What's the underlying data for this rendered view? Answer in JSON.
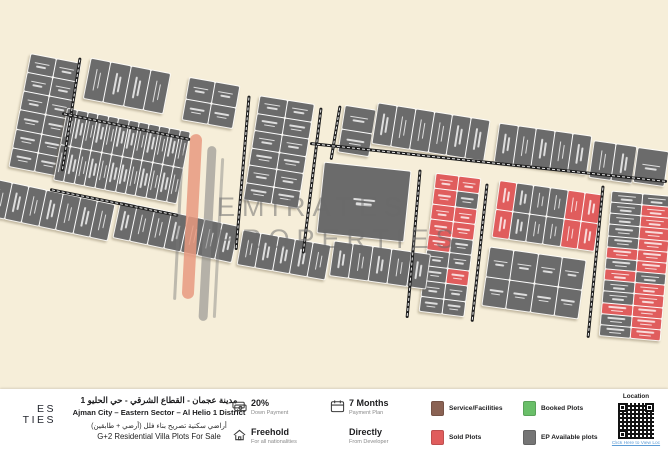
{
  "map": {
    "colors": {
      "background": "#f6eed9",
      "available": "#6b6b6b",
      "sold": "#e05d5d",
      "road": "#1f1f1f",
      "watermark_accent": "#e8997f"
    },
    "watermark": {
      "line1": "EMIRATES",
      "line2": "PROPERTIES"
    },
    "blocks": [
      {
        "id": "b1",
        "x": 20,
        "y": 58,
        "w": 50,
        "h": 114,
        "rot": 11,
        "cols": 2,
        "rows": 6
      },
      {
        "id": "b2",
        "x": 87,
        "y": 66,
        "w": 80,
        "h": 40,
        "rot": 11,
        "cols": 4,
        "rows": 1
      },
      {
        "id": "b3",
        "x": 186,
        "y": 82,
        "w": 50,
        "h": 42,
        "rot": 10,
        "cols": 2,
        "rows": 2
      },
      {
        "id": "b4",
        "x": 60,
        "y": 120,
        "w": 124,
        "h": 72,
        "rot": 11,
        "cols": 12,
        "rows": 2
      },
      {
        "id": "b6",
        "x": 252,
        "y": 100,
        "w": 54,
        "h": 104,
        "rot": 9,
        "cols": 2,
        "rows": 6
      },
      {
        "id": "b7",
        "x": 342,
        "y": 108,
        "w": 30,
        "h": 46,
        "rot": 9,
        "cols": 1,
        "rows": 2
      },
      {
        "id": "rt1",
        "x": 375,
        "y": 112,
        "w": 112,
        "h": 40,
        "rot": 9,
        "cols": 6,
        "rows": 1
      },
      {
        "id": "rt2",
        "x": 497,
        "y": 130,
        "w": 92,
        "h": 38,
        "rot": 8,
        "cols": 5,
        "rows": 1
      },
      {
        "id": "rt3",
        "x": 592,
        "y": 144,
        "w": 42,
        "h": 36,
        "rot": 8,
        "cols": 2,
        "rows": 1
      },
      {
        "id": "rt4",
        "x": 636,
        "y": 150,
        "w": 30,
        "h": 34,
        "rot": 8,
        "cols": 1,
        "rows": 1
      },
      {
        "id": "facility",
        "x": 321,
        "y": 167,
        "w": 86,
        "h": 70,
        "rot": 6,
        "cols": 1,
        "rows": 1,
        "kind": "facility"
      },
      {
        "id": "b11",
        "x": 428,
        "y": 176,
        "w": 44,
        "h": 138,
        "rot": 7,
        "cols": 2,
        "rows": 9,
        "status": [
          "ss",
          "sa",
          "ss",
          "ss",
          "sa",
          "aa",
          "as",
          "aa",
          "aa"
        ]
      },
      {
        "id": "rb1",
        "x": 496,
        "y": 188,
        "w": 102,
        "h": 56,
        "rot": 8,
        "cols": 6,
        "rows": 2,
        "status": [
          "saaass",
          "saaass"
        ]
      },
      {
        "id": "rb2",
        "x": 486,
        "y": 254,
        "w": 96,
        "h": 58,
        "rot": 8,
        "cols": 4,
        "rows": 2
      },
      {
        "id": "rb3",
        "x": 606,
        "y": 194,
        "w": 60,
        "h": 144,
        "rot": 5,
        "cols": 2,
        "rows": 13,
        "status": [
          "aa",
          "as",
          "as",
          "as",
          "as",
          "ss",
          "as",
          "sa",
          "as",
          "as",
          "ss",
          "as",
          "as"
        ]
      },
      {
        "id": "bl1",
        "x": -10,
        "y": 192,
        "w": 122,
        "h": 36,
        "rot": 12,
        "cols": 7,
        "rows": 1
      },
      {
        "id": "bl2",
        "x": 116,
        "y": 214,
        "w": 120,
        "h": 36,
        "rot": 12,
        "cols": 7,
        "rows": 1
      },
      {
        "id": "bl3",
        "x": 240,
        "y": 238,
        "w": 88,
        "h": 34,
        "rot": 10,
        "cols": 5,
        "rows": 1
      },
      {
        "id": "bl4",
        "x": 332,
        "y": 248,
        "w": 96,
        "h": 34,
        "rot": 8,
        "cols": 5,
        "rows": 1
      }
    ],
    "roads": [
      {
        "x1": 80,
        "y1": 56,
        "x2": 62,
        "y2": 170
      },
      {
        "x1": 62,
        "y1": 112,
        "x2": 190,
        "y2": 138
      },
      {
        "x1": 50,
        "y1": 188,
        "x2": 178,
        "y2": 214
      },
      {
        "x1": 249,
        "y1": 94,
        "x2": 236,
        "y2": 248
      },
      {
        "x1": 321,
        "y1": 106,
        "x2": 303,
        "y2": 252
      },
      {
        "x1": 340,
        "y1": 104,
        "x2": 331,
        "y2": 158
      },
      {
        "x1": 310,
        "y1": 142,
        "x2": 667,
        "y2": 180
      },
      {
        "x1": 420,
        "y1": 168,
        "x2": 407,
        "y2": 316
      },
      {
        "x1": 487,
        "y1": 182,
        "x2": 472,
        "y2": 320
      },
      {
        "x1": 603,
        "y1": 184,
        "x2": 588,
        "y2": 336
      }
    ]
  },
  "footer": {
    "logo_fragment": {
      "line1": "ES",
      "line2": "TIES"
    },
    "title": {
      "ar_line1": "مدينة عجمان - القطاع الشرقي - حي الحليو 1",
      "en_line1": "Ajman City – Eastern Sector – Al Helio 1 District",
      "ar_line2": "أراضي سكنية تصريح بناء فلل (أرضي + طابقين)",
      "en_line2": "G+2 Residential Villa Plots For Sale"
    },
    "features": [
      {
        "title": "20%",
        "subtitle": "Down Payment"
      },
      {
        "title": "7 Months",
        "subtitle": "Payment Plan"
      },
      {
        "title": "Freehold",
        "subtitle": "For all nationalities"
      },
      {
        "title": "Directly",
        "subtitle": "From Developer"
      }
    ],
    "legend": [
      {
        "label": "Service/Facilities",
        "color": "#8a6253"
      },
      {
        "label": "Booked Plots",
        "color": "#6abf69"
      },
      {
        "label": "Sold Plots",
        "color": "#e05d5d"
      },
      {
        "label": "EP Available plots",
        "color": "#757575"
      }
    ],
    "location": {
      "label": "Location",
      "link_text": "Click Here to View Loc"
    }
  }
}
